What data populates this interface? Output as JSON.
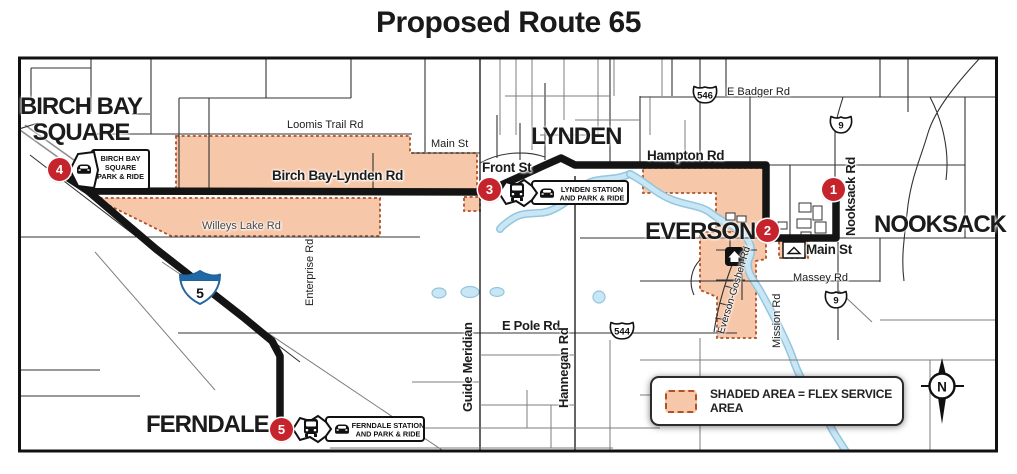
{
  "title": "Proposed Route 65",
  "cities": {
    "birch_bay_line1": "BIRCH BAY",
    "birch_bay_line2": "SQUARE",
    "lynden": "LYNDEN",
    "everson": "EVERSON",
    "nooksack": "NOOKSACK",
    "ferndale": "FERNDALE"
  },
  "stops": [
    {
      "number": "1"
    },
    {
      "number": "2"
    },
    {
      "number": "3"
    },
    {
      "number": "4"
    },
    {
      "number": "5"
    }
  ],
  "stations": {
    "birch_bay": {
      "line1": "BIRCH BAY",
      "line2": "SQUARE",
      "line3": "PARK & RIDE"
    },
    "lynden": {
      "line1": "LYNDEN STATION",
      "line2": "AND PARK & RIDE"
    },
    "ferndale": {
      "line1": "FERNDALE STATION",
      "line2": "AND PARK & RIDE"
    }
  },
  "roads": {
    "loomis_trail": "Loomis Trail Rd",
    "main_st_lynden": "Main St",
    "birch_bay_lynden": "Birch Bay-Lynden Rd",
    "willeys_lake": "Willeys Lake Rd",
    "enterprise": "Enterprise Rd",
    "front_st": "Front St",
    "hampton": "Hampton Rd",
    "e_badger": "E Badger Rd",
    "nooksack_rd": "Nooksack Rd",
    "main_st_everson": "Main St",
    "massey": "Massey Rd",
    "mission": "Mission Rd",
    "everson_goshen": "Everson-Goshen Rd",
    "e_pole": "E Pole Rd",
    "guide_meridian": "Guide Meridian",
    "hannegan": "Hannegan Rd"
  },
  "shields": {
    "sr546": "546",
    "sr9_north": "9",
    "sr544": "544",
    "sr9_south": "9",
    "i5": "5"
  },
  "legend": {
    "label": "SHADED AREA = FLEX SERVICE AREA"
  },
  "compass": {
    "label": "N"
  },
  "colors": {
    "flex_fill": "#F6C7A9",
    "flex_border": "#AF5227",
    "route": "#141414",
    "stop_red": "#C5242D",
    "water": "#C9E6F5",
    "interstate_blue": "#2069A6"
  }
}
